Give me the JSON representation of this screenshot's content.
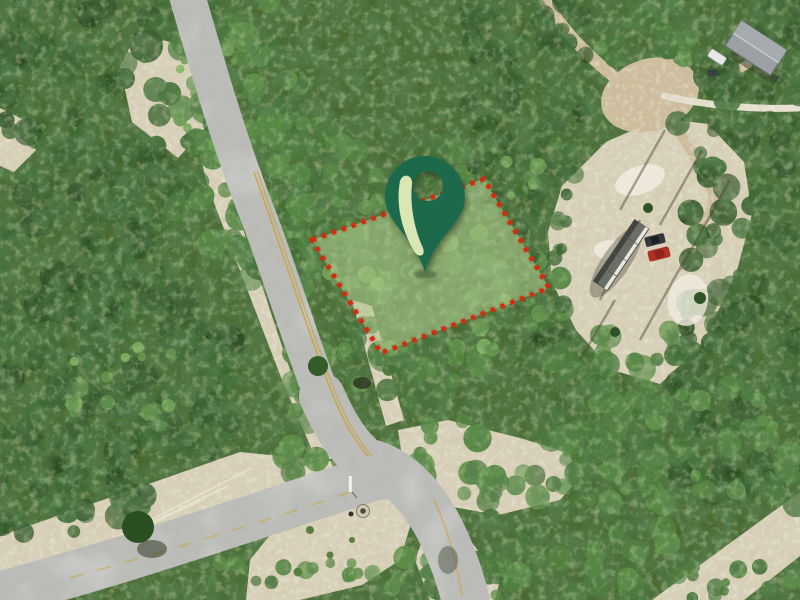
{
  "window": {
    "width": "800",
    "height": "600"
  },
  "scene": {
    "kind": "aerial-drone-photograph-of-vacant-land"
  },
  "overlay": {
    "marker": {
      "label": "map-pin",
      "transform": "translate(425,196)",
      "body_color": "#1b6b4c",
      "accent_color": "#dae7b5"
    },
    "parcel": {
      "label": "highlighted-lot-boundary",
      "points": "312,240 484,179 549,288 381,353",
      "fill": "#adc98d",
      "fill_opacity": "0.58",
      "border_color": "#d52b10"
    }
  },
  "photo": {
    "colors": {
      "forest_base": "#49682f",
      "sand": "#d8d0b8",
      "sand_bright": "#f0ece0",
      "dirt_trail": "#cdbd9c",
      "road": "#bcbdb9",
      "centerline": "#c9a23c",
      "house_roof": "#9aa0a4",
      "trailer": "#6b6e66",
      "car_red": "#ae3126",
      "suv": "#34383c",
      "camper": "#e8e9e6"
    },
    "objects": {
      "road_main": "paved-road-north-south",
      "road_branch_sw": "road-branch-southwest",
      "road_branch_se": "road-branch-southeast",
      "clearing": "sand-clearing",
      "trailer": "travel-trailer",
      "car": "red-car",
      "suv": "dark-suv",
      "house": "house-with-gray-roof",
      "camper": "white-camper",
      "trails": "dirt-trails",
      "dirt_road": "dirt-road-bottom-right",
      "sign": "white-street-sign",
      "culvert": "culvert-drain"
    }
  }
}
